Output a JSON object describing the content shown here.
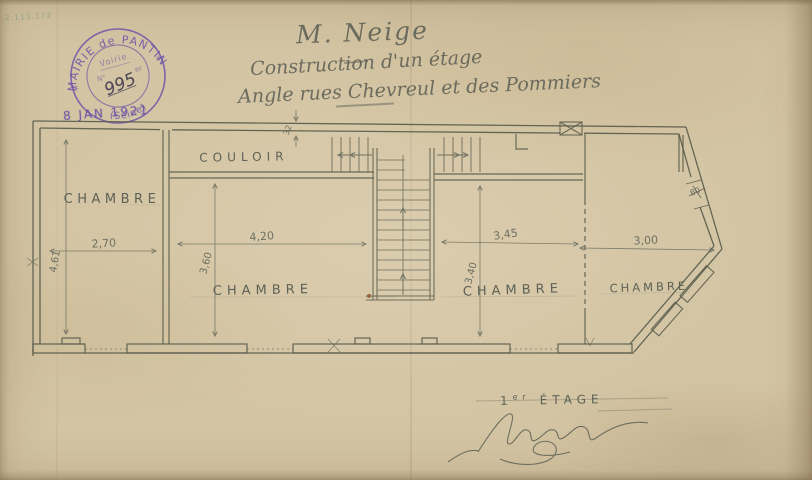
{
  "archive_note": "2.113.172",
  "stamp": {
    "arc_top": "MAIRIE de PANTIN",
    "arc_bottom": "(Seine)",
    "star_left": "*",
    "star_right": "*",
    "office": "Voirie",
    "number_prefix": "N°",
    "number_suffix": "er",
    "number": "995",
    "date": "8 JAN 1921",
    "color": "#6a4fa0"
  },
  "title": {
    "addressee": "M. Neige",
    "line2": "Construction d'un étage",
    "line3": "Angle rues Chevreul et des Pommiers"
  },
  "plan": {
    "ink_color": "#545849",
    "labels": {
      "corridor": "COULOIR",
      "room1": "CHAMBRE",
      "room2": "CHAMBRE",
      "room3": "CHAMBRE",
      "room4": "CHAMBRE"
    },
    "dimensions": {
      "room1_width": "2,70",
      "room1_depth": "4,61",
      "room2_width": "4,20",
      "room2_depth": "3,60",
      "room3_width": "3,45",
      "room3_depth": "3,40",
      "room4_width": "3,00",
      "wall_thickness": "32",
      "corner_window": "80"
    }
  },
  "footer": {
    "floor_num": "1",
    "floor_sup": "er",
    "floor_label": "ÉTAGE",
    "signature": "Neige"
  }
}
